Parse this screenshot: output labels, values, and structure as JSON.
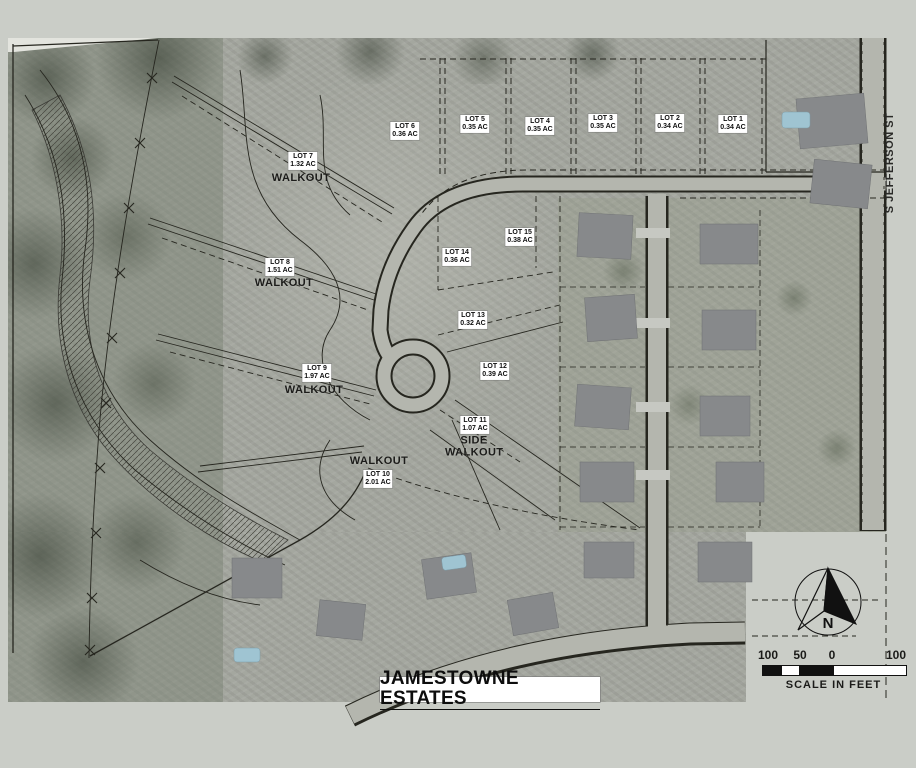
{
  "map": {
    "title": "JAMESTOWNE ESTATES",
    "street_label": "S JEFFERSON ST",
    "north_label": "N",
    "scale": {
      "ticks": [
        "100",
        "50",
        "0",
        "100"
      ],
      "caption": "SCALE IN FEET"
    },
    "lots": [
      {
        "name": "LOT 1",
        "area": "0.34 AC",
        "note": ""
      },
      {
        "name": "LOT 2",
        "area": "0.34 AC",
        "note": ""
      },
      {
        "name": "LOT 3",
        "area": "0.35 AC",
        "note": ""
      },
      {
        "name": "LOT 4",
        "area": "0.35 AC",
        "note": ""
      },
      {
        "name": "LOT 5",
        "area": "0.35 AC",
        "note": ""
      },
      {
        "name": "LOT 6",
        "area": "0.36 AC",
        "note": ""
      },
      {
        "name": "LOT 7",
        "area": "1.32 AC",
        "note": "WALKOUT"
      },
      {
        "name": "LOT 8",
        "area": "1.51 AC",
        "note": "WALKOUT"
      },
      {
        "name": "LOT 9",
        "area": "1.97 AC",
        "note": "WALKOUT"
      },
      {
        "name": "LOT 10",
        "area": "2.01 AC",
        "note": "WALKOUT"
      },
      {
        "name": "LOT 11",
        "area": "1.07 AC",
        "note": "SIDE WALKOUT"
      },
      {
        "name": "LOT 12",
        "area": "0.39 AC",
        "note": ""
      },
      {
        "name": "LOT 13",
        "area": "0.32 AC",
        "note": ""
      },
      {
        "name": "LOT 14",
        "area": "0.36 AC",
        "note": ""
      },
      {
        "name": "LOT 15",
        "area": "0.38 AC",
        "note": ""
      }
    ]
  },
  "colors": {
    "bg": "#cacdc7",
    "photo": "#a4a79f",
    "road": "#b4b6ae",
    "line": "#26261f",
    "chip": "#ffffff",
    "pool": "#9fc4d2"
  }
}
